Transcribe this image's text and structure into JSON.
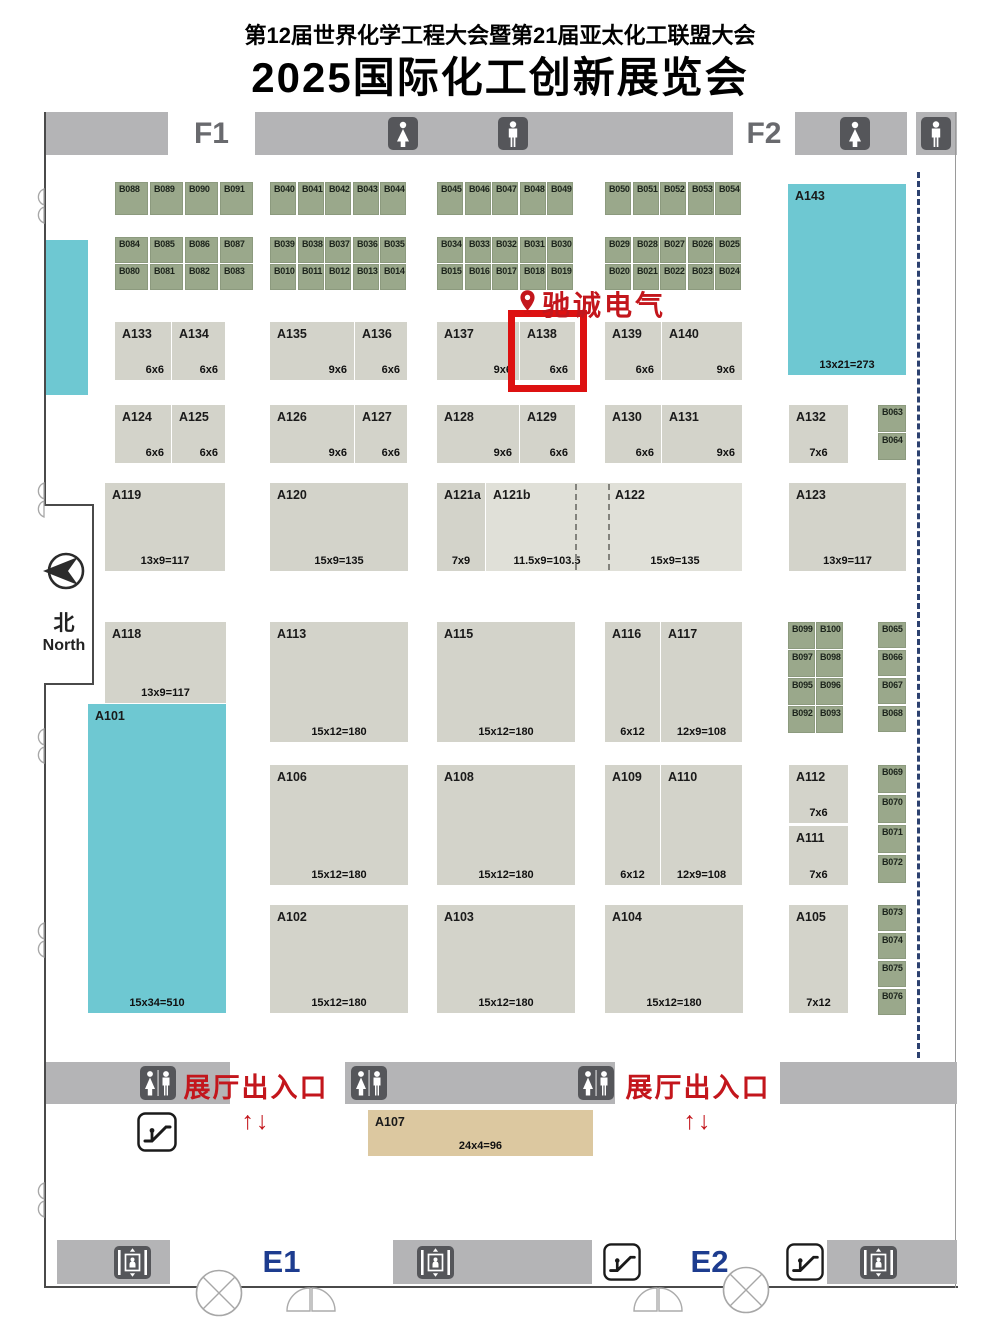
{
  "title": {
    "line1": "第12届世界化学工程大会暨第21届亚太化工联盟大会",
    "line2": "2025国际化工创新展览会"
  },
  "labels": {
    "f1": "F1",
    "f2": "F2",
    "e1": "E1",
    "e2": "E2",
    "north_zh": "北",
    "north_en": "North",
    "marker": "驰诚电气",
    "entrance": "展厅出入口",
    "entrance_arrows": "↑↓"
  },
  "colors": {
    "booth_gray": "#d3d3ca",
    "booth_gray_light": "#e0e0d8",
    "booth_green": "#9aa88b",
    "teal": "#6ec8d2",
    "tan": "#dcc8a0",
    "bar_gray": "#b4b4b6",
    "icon_dark": "#55565a",
    "red": "#c3161c",
    "highlight_red": "#dd1111",
    "navy": "#1d3c8f",
    "dash_navy": "#2c4170",
    "wall": "#4a4a4a"
  },
  "dividers": {
    "hall": {
      "x": 917,
      "y": 172,
      "h": 886
    },
    "booth_dashes": [
      {
        "x": 575,
        "y": 484,
        "h": 86
      },
      {
        "x": 608,
        "y": 484,
        "h": 86
      }
    ]
  },
  "fixtures": [
    {
      "t": "restroom-female",
      "x": 388,
      "y": 117,
      "w": 30,
      "h": 33
    },
    {
      "t": "restroom-male",
      "x": 498,
      "y": 117,
      "w": 30,
      "h": 33
    },
    {
      "t": "restroom-female",
      "x": 840,
      "y": 117,
      "w": 30,
      "h": 33
    },
    {
      "t": "restroom-male",
      "x": 921,
      "y": 117,
      "w": 30,
      "h": 33
    },
    {
      "t": "restroom-unisex",
      "x": 140,
      "y": 1066,
      "w": 36,
      "h": 34
    },
    {
      "t": "restroom-unisex",
      "x": 351,
      "y": 1066,
      "w": 36,
      "h": 34
    },
    {
      "t": "restroom-unisex",
      "x": 578,
      "y": 1066,
      "w": 36,
      "h": 34
    },
    {
      "t": "escalator",
      "x": 137,
      "y": 1112,
      "w": 40,
      "h": 40
    },
    {
      "t": "escalator",
      "x": 602,
      "y": 1243,
      "w": 40,
      "h": 38
    },
    {
      "t": "escalator",
      "x": 785,
      "y": 1243,
      "w": 40,
      "h": 38
    },
    {
      "t": "elevator",
      "x": 114,
      "y": 1246,
      "w": 37,
      "h": 33
    },
    {
      "t": "elevator",
      "x": 417,
      "y": 1246,
      "w": 37,
      "h": 33
    },
    {
      "t": "elevator",
      "x": 860,
      "y": 1246,
      "w": 37,
      "h": 33
    }
  ],
  "booths": [
    {
      "id": "B088",
      "x": 115,
      "y": 182,
      "w": 33,
      "h": 33,
      "c": "g"
    },
    {
      "id": "B089",
      "x": 150,
      "y": 182,
      "w": 33,
      "h": 33,
      "c": "g"
    },
    {
      "id": "B090",
      "x": 185,
      "y": 182,
      "w": 33,
      "h": 33,
      "c": "g"
    },
    {
      "id": "B091",
      "x": 220,
      "y": 182,
      "w": 33,
      "h": 33,
      "c": "g"
    },
    {
      "id": "B040",
      "x": 270,
      "y": 182,
      "w": 26,
      "h": 33,
      "c": "g"
    },
    {
      "id": "B041",
      "x": 298,
      "y": 182,
      "w": 26,
      "h": 33,
      "c": "g"
    },
    {
      "id": "B042",
      "x": 325,
      "y": 182,
      "w": 26,
      "h": 33,
      "c": "g"
    },
    {
      "id": "B043",
      "x": 353,
      "y": 182,
      "w": 26,
      "h": 33,
      "c": "g"
    },
    {
      "id": "B044",
      "x": 380,
      "y": 182,
      "w": 26,
      "h": 33,
      "c": "g"
    },
    {
      "id": "B045",
      "x": 437,
      "y": 182,
      "w": 26,
      "h": 33,
      "c": "g"
    },
    {
      "id": "B046",
      "x": 465,
      "y": 182,
      "w": 26,
      "h": 33,
      "c": "g"
    },
    {
      "id": "B047",
      "x": 492,
      "y": 182,
      "w": 26,
      "h": 33,
      "c": "g"
    },
    {
      "id": "B048",
      "x": 520,
      "y": 182,
      "w": 26,
      "h": 33,
      "c": "g"
    },
    {
      "id": "B049",
      "x": 547,
      "y": 182,
      "w": 26,
      "h": 33,
      "c": "g"
    },
    {
      "id": "B050",
      "x": 605,
      "y": 182,
      "w": 26,
      "h": 33,
      "c": "g"
    },
    {
      "id": "B051",
      "x": 633,
      "y": 182,
      "w": 26,
      "h": 33,
      "c": "g"
    },
    {
      "id": "B052",
      "x": 660,
      "y": 182,
      "w": 26,
      "h": 33,
      "c": "g"
    },
    {
      "id": "B053",
      "x": 688,
      "y": 182,
      "w": 26,
      "h": 33,
      "c": "g"
    },
    {
      "id": "B054",
      "x": 715,
      "y": 182,
      "w": 26,
      "h": 33,
      "c": "g"
    },
    {
      "id": "B084",
      "x": 115,
      "y": 237,
      "w": 33,
      "h": 26,
      "c": "g"
    },
    {
      "id": "B085",
      "x": 150,
      "y": 237,
      "w": 33,
      "h": 26,
      "c": "g"
    },
    {
      "id": "B086",
      "x": 185,
      "y": 237,
      "w": 33,
      "h": 26,
      "c": "g"
    },
    {
      "id": "B087",
      "x": 220,
      "y": 237,
      "w": 33,
      "h": 26,
      "c": "g"
    },
    {
      "id": "B080",
      "x": 115,
      "y": 264,
      "w": 33,
      "h": 26,
      "c": "g"
    },
    {
      "id": "B081",
      "x": 150,
      "y": 264,
      "w": 33,
      "h": 26,
      "c": "g"
    },
    {
      "id": "B082",
      "x": 185,
      "y": 264,
      "w": 33,
      "h": 26,
      "c": "g"
    },
    {
      "id": "B083",
      "x": 220,
      "y": 264,
      "w": 33,
      "h": 26,
      "c": "g"
    },
    {
      "id": "B039",
      "x": 270,
      "y": 237,
      "w": 26,
      "h": 26,
      "c": "g"
    },
    {
      "id": "B038",
      "x": 298,
      "y": 237,
      "w": 26,
      "h": 26,
      "c": "g"
    },
    {
      "id": "B037",
      "x": 325,
      "y": 237,
      "w": 26,
      "h": 26,
      "c": "g"
    },
    {
      "id": "B036",
      "x": 353,
      "y": 237,
      "w": 26,
      "h": 26,
      "c": "g"
    },
    {
      "id": "B035",
      "x": 380,
      "y": 237,
      "w": 26,
      "h": 26,
      "c": "g"
    },
    {
      "id": "B010",
      "x": 270,
      "y": 264,
      "w": 26,
      "h": 26,
      "c": "g"
    },
    {
      "id": "B011",
      "x": 298,
      "y": 264,
      "w": 26,
      "h": 26,
      "c": "g"
    },
    {
      "id": "B012",
      "x": 325,
      "y": 264,
      "w": 26,
      "h": 26,
      "c": "g"
    },
    {
      "id": "B013",
      "x": 353,
      "y": 264,
      "w": 26,
      "h": 26,
      "c": "g"
    },
    {
      "id": "B014",
      "x": 380,
      "y": 264,
      "w": 26,
      "h": 26,
      "c": "g"
    },
    {
      "id": "B034",
      "x": 437,
      "y": 237,
      "w": 26,
      "h": 26,
      "c": "g"
    },
    {
      "id": "B033",
      "x": 465,
      "y": 237,
      "w": 26,
      "h": 26,
      "c": "g"
    },
    {
      "id": "B032",
      "x": 492,
      "y": 237,
      "w": 26,
      "h": 26,
      "c": "g"
    },
    {
      "id": "B031",
      "x": 520,
      "y": 237,
      "w": 26,
      "h": 26,
      "c": "g"
    },
    {
      "id": "B030",
      "x": 547,
      "y": 237,
      "w": 26,
      "h": 26,
      "c": "g"
    },
    {
      "id": "B015",
      "x": 437,
      "y": 264,
      "w": 26,
      "h": 26,
      "c": "g"
    },
    {
      "id": "B016",
      "x": 465,
      "y": 264,
      "w": 26,
      "h": 26,
      "c": "g"
    },
    {
      "id": "B017",
      "x": 492,
      "y": 264,
      "w": 26,
      "h": 26,
      "c": "g"
    },
    {
      "id": "B018",
      "x": 520,
      "y": 264,
      "w": 26,
      "h": 26,
      "c": "g"
    },
    {
      "id": "B019",
      "x": 547,
      "y": 264,
      "w": 26,
      "h": 26,
      "c": "g"
    },
    {
      "id": "B029",
      "x": 605,
      "y": 237,
      "w": 26,
      "h": 26,
      "c": "g"
    },
    {
      "id": "B028",
      "x": 633,
      "y": 237,
      "w": 26,
      "h": 26,
      "c": "g"
    },
    {
      "id": "B027",
      "x": 660,
      "y": 237,
      "w": 26,
      "h": 26,
      "c": "g"
    },
    {
      "id": "B026",
      "x": 688,
      "y": 237,
      "w": 26,
      "h": 26,
      "c": "g"
    },
    {
      "id": "B025",
      "x": 715,
      "y": 237,
      "w": 26,
      "h": 26,
      "c": "g"
    },
    {
      "id": "B020",
      "x": 605,
      "y": 264,
      "w": 26,
      "h": 26,
      "c": "g"
    },
    {
      "id": "B021",
      "x": 633,
      "y": 264,
      "w": 26,
      "h": 26,
      "c": "g"
    },
    {
      "id": "B022",
      "x": 660,
      "y": 264,
      "w": 26,
      "h": 26,
      "c": "g"
    },
    {
      "id": "B023",
      "x": 688,
      "y": 264,
      "w": 26,
      "h": 26,
      "c": "g"
    },
    {
      "id": "B024",
      "x": 715,
      "y": 264,
      "w": 26,
      "h": 26,
      "c": "g"
    },
    {
      "id": "B063",
      "x": 878,
      "y": 405,
      "w": 28,
      "h": 27,
      "c": "g"
    },
    {
      "id": "B064",
      "x": 878,
      "y": 433,
      "w": 28,
      "h": 27,
      "c": "g"
    },
    {
      "id": "B099",
      "x": 788,
      "y": 622,
      "w": 27,
      "h": 27,
      "c": "g"
    },
    {
      "id": "B100",
      "x": 816,
      "y": 622,
      "w": 27,
      "h": 27,
      "c": "g"
    },
    {
      "id": "B097",
      "x": 788,
      "y": 650,
      "w": 27,
      "h": 27,
      "c": "g"
    },
    {
      "id": "B098",
      "x": 816,
      "y": 650,
      "w": 27,
      "h": 27,
      "c": "g"
    },
    {
      "id": "B095",
      "x": 788,
      "y": 678,
      "w": 27,
      "h": 27,
      "c": "g"
    },
    {
      "id": "B096",
      "x": 816,
      "y": 678,
      "w": 27,
      "h": 27,
      "c": "g"
    },
    {
      "id": "B092",
      "x": 788,
      "y": 706,
      "w": 27,
      "h": 27,
      "c": "g"
    },
    {
      "id": "B093",
      "x": 816,
      "y": 706,
      "w": 27,
      "h": 27,
      "c": "g"
    },
    {
      "id": "B065",
      "x": 878,
      "y": 622,
      "w": 28,
      "h": 26,
      "c": "g"
    },
    {
      "id": "B066",
      "x": 878,
      "y": 650,
      "w": 28,
      "h": 26,
      "c": "g"
    },
    {
      "id": "B067",
      "x": 878,
      "y": 678,
      "w": 28,
      "h": 26,
      "c": "g"
    },
    {
      "id": "B068",
      "x": 878,
      "y": 706,
      "w": 28,
      "h": 26,
      "c": "g"
    },
    {
      "id": "B069",
      "x": 878,
      "y": 765,
      "w": 28,
      "h": 28,
      "c": "g"
    },
    {
      "id": "B070",
      "x": 878,
      "y": 795,
      "w": 28,
      "h": 28,
      "c": "g"
    },
    {
      "id": "B071",
      "x": 878,
      "y": 825,
      "w": 28,
      "h": 28,
      "c": "g"
    },
    {
      "id": "B072",
      "x": 878,
      "y": 855,
      "w": 28,
      "h": 28,
      "c": "g"
    },
    {
      "id": "B073",
      "x": 878,
      "y": 905,
      "w": 28,
      "h": 26,
      "c": "g"
    },
    {
      "id": "B074",
      "x": 878,
      "y": 933,
      "w": 28,
      "h": 26,
      "c": "g"
    },
    {
      "id": "B075",
      "x": 878,
      "y": 961,
      "w": 28,
      "h": 26,
      "c": "g"
    },
    {
      "id": "B076",
      "x": 878,
      "y": 989,
      "w": 28,
      "h": 26,
      "c": "g"
    },
    {
      "id": "A143",
      "x": 788,
      "y": 184,
      "w": 118,
      "h": 191,
      "c": "t",
      "s": "13x21=273",
      "al": "c"
    },
    {
      "id": "A133",
      "x": 115,
      "y": 322,
      "w": 56,
      "h": 58,
      "c": "a",
      "s": "6x6",
      "al": "r"
    },
    {
      "id": "A134",
      "x": 172,
      "y": 322,
      "w": 53,
      "h": 58,
      "c": "a",
      "s": "6x6",
      "al": "r"
    },
    {
      "id": "A135",
      "x": 270,
      "y": 322,
      "w": 84,
      "h": 58,
      "c": "a",
      "s": "9x6",
      "al": "r"
    },
    {
      "id": "A136",
      "x": 355,
      "y": 322,
      "w": 52,
      "h": 58,
      "c": "a",
      "s": "6x6",
      "al": "r"
    },
    {
      "id": "A137",
      "x": 437,
      "y": 322,
      "w": 82,
      "h": 58,
      "c": "a",
      "s": "9x6",
      "al": "r"
    },
    {
      "id": "A138",
      "x": 520,
      "y": 322,
      "w": 55,
      "h": 58,
      "c": "a",
      "s": "6x6",
      "al": "r",
      "hl": true
    },
    {
      "id": "A139",
      "x": 605,
      "y": 322,
      "w": 56,
      "h": 58,
      "c": "a",
      "s": "6x6",
      "al": "r"
    },
    {
      "id": "A140",
      "x": 662,
      "y": 322,
      "w": 80,
      "h": 58,
      "c": "a",
      "s": "9x6",
      "al": "r"
    },
    {
      "id": "A124",
      "x": 115,
      "y": 405,
      "w": 56,
      "h": 58,
      "c": "a",
      "s": "6x6",
      "al": "r"
    },
    {
      "id": "A125",
      "x": 172,
      "y": 405,
      "w": 53,
      "h": 58,
      "c": "a",
      "s": "6x6",
      "al": "r"
    },
    {
      "id": "A126",
      "x": 270,
      "y": 405,
      "w": 84,
      "h": 58,
      "c": "a",
      "s": "9x6",
      "al": "r"
    },
    {
      "id": "A127",
      "x": 355,
      "y": 405,
      "w": 52,
      "h": 58,
      "c": "a",
      "s": "6x6",
      "al": "r"
    },
    {
      "id": "A128",
      "x": 437,
      "y": 405,
      "w": 82,
      "h": 58,
      "c": "a",
      "s": "9x6",
      "al": "r"
    },
    {
      "id": "A129",
      "x": 520,
      "y": 405,
      "w": 55,
      "h": 58,
      "c": "a",
      "s": "6x6",
      "al": "r"
    },
    {
      "id": "A130",
      "x": 605,
      "y": 405,
      "w": 56,
      "h": 58,
      "c": "a",
      "s": "6x6",
      "al": "r"
    },
    {
      "id": "A131",
      "x": 662,
      "y": 405,
      "w": 80,
      "h": 58,
      "c": "a",
      "s": "9x6",
      "al": "r"
    },
    {
      "id": "A132",
      "x": 789,
      "y": 405,
      "w": 59,
      "h": 58,
      "c": "a",
      "s": "7x6",
      "al": "c"
    },
    {
      "id": "A119",
      "x": 105,
      "y": 483,
      "w": 120,
      "h": 88,
      "c": "a",
      "s": "13x9=117",
      "al": "c"
    },
    {
      "id": "A120",
      "x": 270,
      "y": 483,
      "w": 138,
      "h": 88,
      "c": "a",
      "s": "15x9=135",
      "al": "c"
    },
    {
      "id": "A121a",
      "x": 437,
      "y": 483,
      "w": 48,
      "h": 88,
      "c": "a",
      "s": "7x9",
      "al": "c"
    },
    {
      "id": "A121b",
      "x": 486,
      "y": 483,
      "w": 122,
      "h": 88,
      "c": "l",
      "s": "11.5x9=103.5",
      "al": "c"
    },
    {
      "id": "A122",
      "x": 608,
      "y": 483,
      "w": 134,
      "h": 88,
      "c": "l",
      "s": "15x9=135",
      "al": "c"
    },
    {
      "id": "A123",
      "x": 789,
      "y": 483,
      "w": 117,
      "h": 88,
      "c": "a",
      "s": "13x9=117",
      "al": "c"
    },
    {
      "id": "A118",
      "x": 105,
      "y": 622,
      "w": 121,
      "h": 81,
      "c": "a",
      "s": "13x9=117",
      "al": "c"
    },
    {
      "id": "A113",
      "x": 270,
      "y": 622,
      "w": 138,
      "h": 120,
      "c": "a",
      "s": "15x12=180",
      "al": "c"
    },
    {
      "id": "A115",
      "x": 437,
      "y": 622,
      "w": 138,
      "h": 120,
      "c": "a",
      "s": "15x12=180",
      "al": "c"
    },
    {
      "id": "A116",
      "x": 605,
      "y": 622,
      "w": 55,
      "h": 120,
      "c": "a",
      "s": "6x12",
      "al": "c"
    },
    {
      "id": "A117",
      "x": 661,
      "y": 622,
      "w": 81,
      "h": 120,
      "c": "a",
      "s": "12x9=108",
      "al": "c"
    },
    {
      "id": "A101",
      "x": 88,
      "y": 704,
      "w": 138,
      "h": 309,
      "c": "t",
      "s": "15x34=510",
      "al": "c"
    },
    {
      "id": "A106",
      "x": 270,
      "y": 765,
      "w": 138,
      "h": 120,
      "c": "a",
      "s": "15x12=180",
      "al": "c"
    },
    {
      "id": "A108",
      "x": 437,
      "y": 765,
      "w": 138,
      "h": 120,
      "c": "a",
      "s": "15x12=180",
      "al": "c"
    },
    {
      "id": "A109",
      "x": 605,
      "y": 765,
      "w": 55,
      "h": 120,
      "c": "a",
      "s": "6x12",
      "al": "c"
    },
    {
      "id": "A110",
      "x": 661,
      "y": 765,
      "w": 81,
      "h": 120,
      "c": "a",
      "s": "12x9=108",
      "al": "c"
    },
    {
      "id": "A112",
      "x": 789,
      "y": 765,
      "w": 59,
      "h": 58,
      "c": "a",
      "s": "7x6",
      "al": "c"
    },
    {
      "id": "A111",
      "x": 789,
      "y": 826,
      "w": 59,
      "h": 59,
      "c": "a",
      "s": "7x6",
      "al": "c"
    },
    {
      "id": "A102",
      "x": 270,
      "y": 905,
      "w": 138,
      "h": 108,
      "c": "a",
      "s": "15x12=180",
      "al": "c"
    },
    {
      "id": "A103",
      "x": 437,
      "y": 905,
      "w": 138,
      "h": 108,
      "c": "a",
      "s": "15x12=180",
      "al": "c"
    },
    {
      "id": "A104",
      "x": 605,
      "y": 905,
      "w": 138,
      "h": 108,
      "c": "a",
      "s": "15x12=180",
      "al": "c"
    },
    {
      "id": "A105",
      "x": 789,
      "y": 905,
      "w": 59,
      "h": 108,
      "c": "a",
      "s": "7x12",
      "al": "c"
    },
    {
      "id": "A107",
      "x": 368,
      "y": 1110,
      "w": 225,
      "h": 46,
      "c": "n",
      "s": "24x4=96",
      "al": "c"
    }
  ]
}
